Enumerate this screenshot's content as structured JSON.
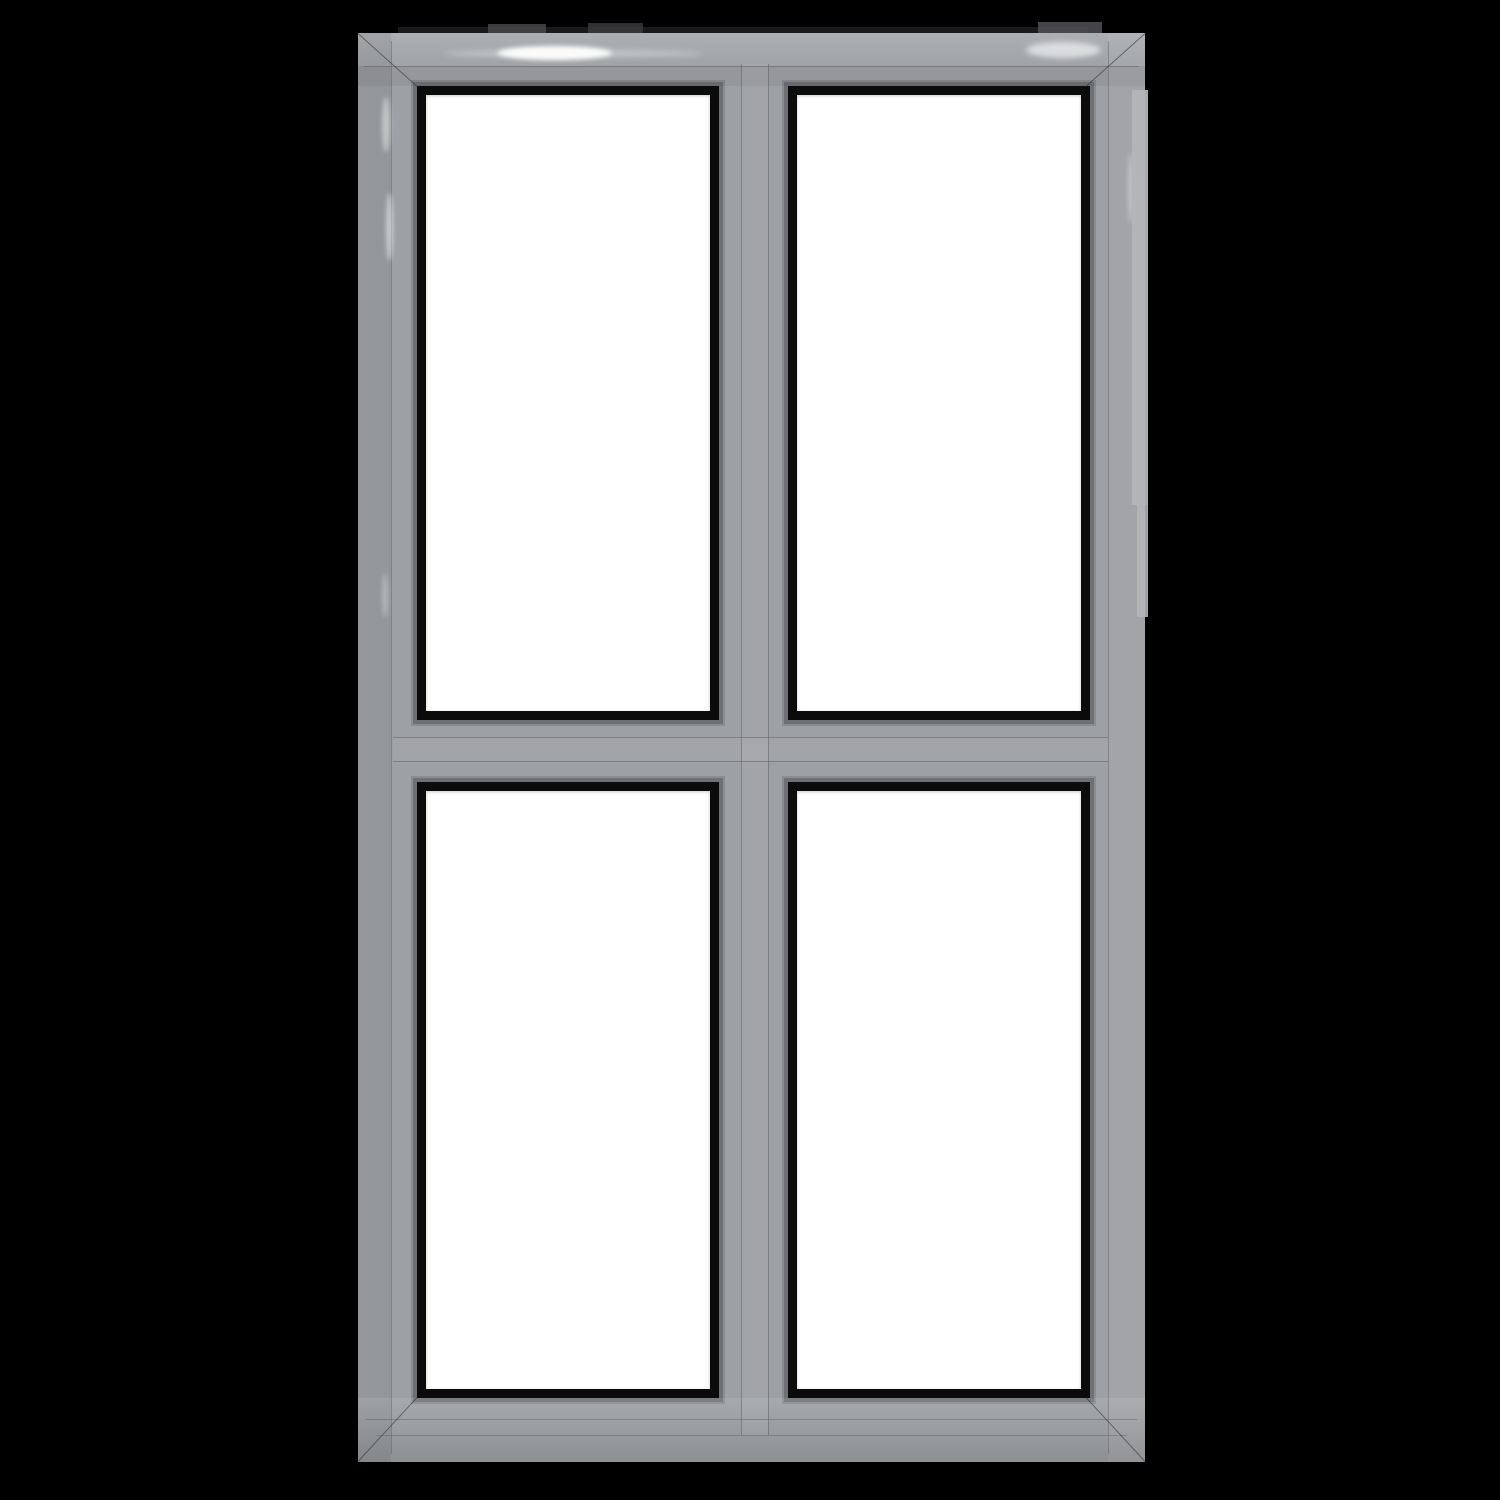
{
  "scene": {
    "subject": "aluminum-four-pane-window-frame",
    "background": "solid black",
    "grid": {
      "rows": 2,
      "cols": 2
    },
    "panes": [
      {
        "id": "top-left",
        "fill": "white glass"
      },
      {
        "id": "top-right",
        "fill": "white glass"
      },
      {
        "id": "bottom-left",
        "fill": "white glass"
      },
      {
        "id": "bottom-right",
        "fill": "white glass"
      }
    ],
    "features": [
      "mitered corner joints",
      "vertical center mullion with twin grooves",
      "horizontal center transom with twin grooves",
      "black rubber glazing gaskets",
      "glossy paint highlights on top and left members",
      "light reflection band along upper right edge"
    ]
  },
  "colors": {
    "background": "#000000",
    "frame_base": "#9da0a4",
    "frame_light": "#aeb0b4",
    "frame_dark": "#8c8e93",
    "seam": "#5f6165",
    "gasket": "#0b0b0c",
    "glass": "#ffffff",
    "gloss": "#ffffff",
    "artifact_band": "#b3b5b9",
    "edge_artifact": "#47474b"
  }
}
